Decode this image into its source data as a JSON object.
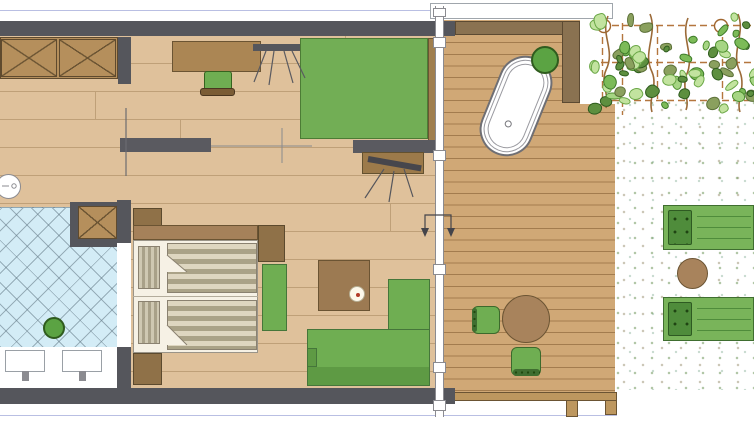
{
  "plan": {
    "type": "architectural-floor-plan",
    "rooms": [
      {
        "name": "entry-wardrobe"
      },
      {
        "name": "bathroom"
      },
      {
        "name": "bedroom-living-room"
      },
      {
        "name": "terrace-deck"
      },
      {
        "name": "gravel-garden-pergola"
      }
    ],
    "objects": [
      "wardrobe-x-panels",
      "wall-shelf",
      "folding-chair-symbol",
      "desk",
      "desk-chair",
      "platform-daybed",
      "tv-sideboard",
      "television",
      "sliding-door-arrows",
      "twin-beds",
      "pillows",
      "duvets",
      "nightstands",
      "green-ottoman",
      "coffee-table",
      "decor-plate",
      "corner-sofa",
      "diagonal-tile-floor",
      "potted-plant",
      "double-vanity-sinks",
      "round-side-table",
      "freestanding-bathtub",
      "deck-potted-plant",
      "terrace-dining-table",
      "terrace-chairs",
      "pergola-grid",
      "pergola-posts",
      "climbing-vines",
      "sun-loungers",
      "lounger-side-table",
      "gravel-stipple",
      "window-wall-mullions",
      "wood-plank-floor",
      "deck-planks"
    ],
    "counts": {
      "sinks": 2,
      "beds": 2,
      "sun_loungers": 2,
      "pergola_posts": 2,
      "terrace_chairs": 2
    }
  },
  "colors": {
    "wall": "#55565c",
    "wood": "#dfc19b",
    "woodline": "#bfa078",
    "deck": "#d0a876",
    "deckline": "#a37c4e",
    "deckframe": "#bd975f",
    "tile": "#d3ecf6",
    "cab": "#b58f5c",
    "cab2": "#ab8654",
    "cab3": "#8f7148",
    "terracewall": "#8a7251",
    "green": "#6fae52",
    "green2": "#72ae55",
    "green3": "#79b45a",
    "plantgreen": "#5ba343",
    "linen": "#f6f1e5",
    "pilA": "#cfc8b2",
    "pilB": "#a9a189",
    "ttable": "#a8835c",
    "lavender": "#b9bfe3",
    "pergola": "#b4763e",
    "vine": "#9b6a38",
    "leaf_light": "#a6d584",
    "leaf_dark": "#5d8f3f"
  }
}
